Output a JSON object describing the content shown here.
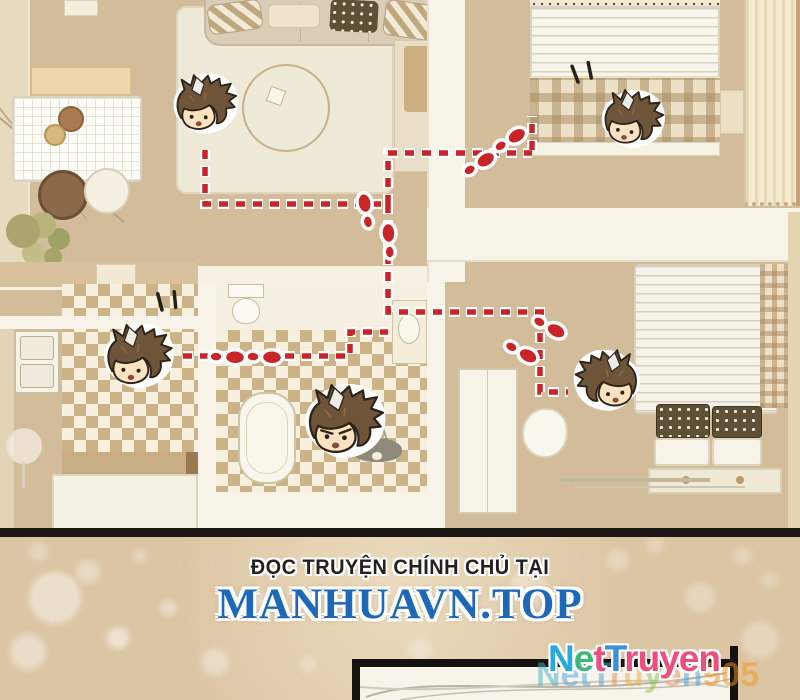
{
  "page": {
    "width": 800,
    "height": 700,
    "background": "#dcc5a3",
    "type": "manhua comic page — apartment floor plan panel with chibi character heads and a red footprint trail"
  },
  "promo": {
    "tagline": "ĐỌC TRUYỆN CHÍNH CHỦ TẠI",
    "site": "MANHUAVN.TOP",
    "tagline_color": "#23211f",
    "site_color": "#1e68ba"
  },
  "logo": {
    "text": "NetTruyen",
    "letters": [
      {
        "ch": "N",
        "color": "#27a9e0"
      },
      {
        "ch": "e",
        "color": "#3cb878"
      },
      {
        "ch": "t",
        "color": "#ee4e7c"
      },
      {
        "ch": "T",
        "color": "#3a90d8"
      },
      {
        "ch": "r",
        "color": "#ee4e7c"
      },
      {
        "ch": "u",
        "color": "#ee4e7c"
      },
      {
        "ch": "y",
        "color": "#ee4e7c"
      },
      {
        "ch": "e",
        "color": "#ee4e7c"
      },
      {
        "ch": "n",
        "color": "#ee4e7c"
      }
    ]
  },
  "watermark": {
    "text": "NetTruyen905",
    "opacity": 0.5,
    "letters": [
      {
        "ch": "N",
        "color": "#3fb4c4"
      },
      {
        "ch": "e",
        "color": "#4aa3da"
      },
      {
        "ch": "t",
        "color": "#4aa3da"
      },
      {
        "ch": "T",
        "color": "#4aa3da"
      },
      {
        "ch": "r",
        "color": "#f08b52"
      },
      {
        "ch": "u",
        "color": "#f2a93b"
      },
      {
        "ch": "y",
        "color": "#8bc34a"
      },
      {
        "ch": "e",
        "color": "#f08b52"
      },
      {
        "ch": "n",
        "color": "#4aa3da"
      },
      {
        "ch": "9",
        "color": "#f7941d"
      },
      {
        "ch": "0",
        "color": "#f7941d"
      },
      {
        "ch": "5",
        "color": "#f7941d"
      }
    ]
  },
  "floorplan": {
    "floor_color": "#d2bc99",
    "trail_color": "#c92428",
    "trail_segments": [
      "M205,150 L205,204 L388,204",
      "M388,204 L388,153 L532,153",
      "M532,150 L532,116",
      "M388,204 L388,312 L546,312",
      "M183,356 L350,356 L350,332 L388,332",
      "M540,316 L540,392 L568,392"
    ],
    "footprints": [
      {
        "x": 366,
        "y": 211,
        "rot": -10
      },
      {
        "x": 389,
        "y": 241,
        "rot": -4
      },
      {
        "x": 479,
        "y": 164,
        "rot": 58
      },
      {
        "x": 510,
        "y": 140,
        "rot": 58
      },
      {
        "x": 227,
        "y": 357,
        "rot": 92
      },
      {
        "x": 264,
        "y": 357,
        "rot": 92
      },
      {
        "x": 549,
        "y": 327,
        "rot": 118
      },
      {
        "x": 521,
        "y": 352,
        "rot": 118
      }
    ],
    "characters": [
      {
        "id": "chibi-head-living-room",
        "x": 168,
        "y": 72,
        "size": 74,
        "flip": false,
        "tilt": -4,
        "expression": "surprised"
      },
      {
        "id": "chibi-head-top-bed",
        "x": 596,
        "y": 88,
        "size": 72,
        "flip": false,
        "tilt": 3,
        "expression": "startled"
      },
      {
        "id": "chibi-head-kitchen",
        "x": 98,
        "y": 322,
        "size": 80,
        "flip": false,
        "tilt": -3,
        "expression": "surprised"
      },
      {
        "id": "chibi-head-bathroom",
        "x": 298,
        "y": 382,
        "size": 92,
        "flip": false,
        "tilt": -2,
        "expression": "angry"
      },
      {
        "id": "chibi-head-bottom-bed",
        "x": 570,
        "y": 348,
        "size": 76,
        "flip": true,
        "tilt": 0,
        "expression": "calm"
      }
    ],
    "speed_marks": [
      {
        "x": 578,
        "y": 82,
        "rot": -38
      },
      {
        "x": 162,
        "y": 310,
        "rot": -32
      }
    ]
  },
  "bokeh": [
    {
      "x": 55,
      "y": 598,
      "r": 26,
      "o": 0.45
    },
    {
      "x": 28,
      "y": 652,
      "r": 18,
      "o": 0.4
    },
    {
      "x": 118,
      "y": 638,
      "r": 11,
      "o": 0.5
    },
    {
      "x": 168,
      "y": 608,
      "r": 8,
      "o": 0.4
    },
    {
      "x": 215,
      "y": 662,
      "r": 14,
      "o": 0.35
    },
    {
      "x": 88,
      "y": 572,
      "r": 12,
      "o": 0.35
    },
    {
      "x": 258,
      "y": 600,
      "r": 9,
      "o": 0.3
    },
    {
      "x": 528,
      "y": 588,
      "r": 18,
      "o": 0.3
    },
    {
      "x": 618,
      "y": 560,
      "r": 11,
      "o": 0.28
    },
    {
      "x": 700,
      "y": 598,
      "r": 15,
      "o": 0.28
    },
    {
      "x": 760,
      "y": 640,
      "r": 18,
      "o": 0.3
    },
    {
      "x": 420,
      "y": 650,
      "r": 11,
      "o": 0.28
    },
    {
      "x": 308,
      "y": 664,
      "r": 8,
      "o": 0.28
    },
    {
      "x": 655,
      "y": 545,
      "r": 8,
      "o": 0.25
    },
    {
      "x": 742,
      "y": 556,
      "r": 9,
      "o": 0.25
    },
    {
      "x": 38,
      "y": 552,
      "r": 9,
      "o": 0.3
    },
    {
      "x": 140,
      "y": 556,
      "r": 7,
      "o": 0.3
    },
    {
      "x": 350,
      "y": 610,
      "r": 6,
      "o": 0.25
    },
    {
      "x": 480,
      "y": 565,
      "r": 7,
      "o": 0.22
    },
    {
      "x": 770,
      "y": 580,
      "r": 8,
      "o": 0.25
    }
  ]
}
